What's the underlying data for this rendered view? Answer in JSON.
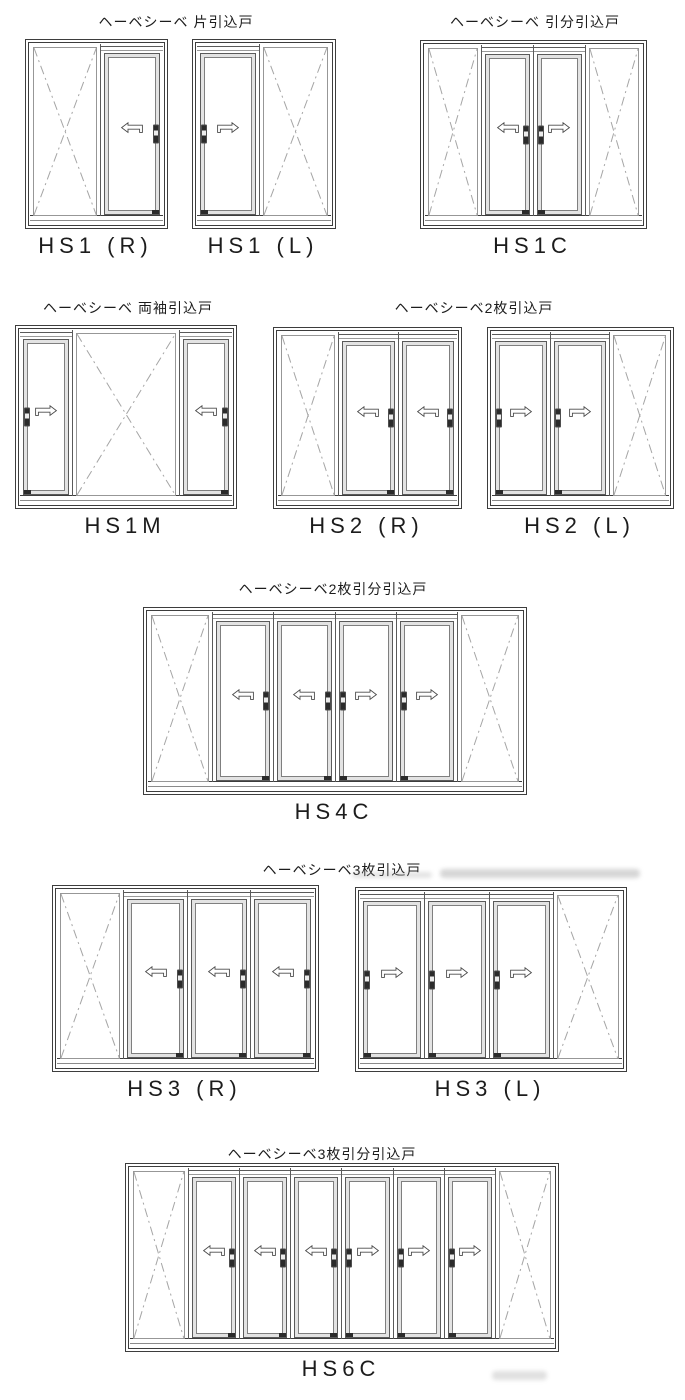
{
  "page": {
    "background": "#ffffff"
  },
  "colors": {
    "frame_line": "#3d3d3d",
    "inner_line": "#5a5a5a",
    "sash_fill": "#e3e3e3",
    "x_line": "#a5a5a5",
    "arrow_line": "#4a4a4a",
    "handle_dark": "#2b2b2b",
    "text": "#1c1c1c"
  },
  "titles": [
    {
      "text": "ヘーベシーベ 片引込戸",
      "cx": 176,
      "y": 12
    },
    {
      "text": "ヘーベシーベ 引分引込戸",
      "cx": 535,
      "y": 12
    },
    {
      "text": "ヘーベシーベ 両袖引込戸",
      "cx": 128,
      "y": 298
    },
    {
      "text": "ヘーベシーベ2枚引込戸",
      "cx": 474,
      "y": 298
    },
    {
      "text": "ヘーベシーベ2枚引分引込戸",
      "cx": 333,
      "y": 579
    },
    {
      "text": "ヘーベシーベ3枚引込戸",
      "cx": 342,
      "y": 860
    },
    {
      "text": "ヘーベシーベ3枚引分引込戸",
      "cx": 322,
      "y": 1144
    }
  ],
  "diagrams": [
    {
      "label": "HS1 (R)",
      "x": 25,
      "y": 39,
      "w": 141,
      "h": 188,
      "panels": [
        {
          "type": "fixed",
          "flex": 1.14
        },
        {
          "type": "door",
          "arrow": "left",
          "handle": "right",
          "flex": 1
        }
      ]
    },
    {
      "label": "HS1 (L)",
      "x": 192,
      "y": 39,
      "w": 142,
      "h": 188,
      "panels": [
        {
          "type": "door",
          "arrow": "right",
          "handle": "left",
          "flex": 1
        },
        {
          "type": "fixed",
          "flex": 1.14
        }
      ]
    },
    {
      "label": "HS1C",
      "x": 420,
      "y": 40,
      "w": 225,
      "h": 187,
      "panels": [
        {
          "type": "fixed",
          "flex": 1.1
        },
        {
          "type": "door",
          "arrow": "left",
          "handle": "right",
          "flex": 1
        },
        {
          "type": "door",
          "arrow": "right",
          "handle": "left",
          "flex": 1
        },
        {
          "type": "fixed",
          "flex": 1.1
        }
      ]
    },
    {
      "label": "HS1M",
      "x": 15,
      "y": 325,
      "w": 220,
      "h": 182,
      "panels": [
        {
          "type": "door",
          "arrow": "right",
          "handle": "left",
          "flex": 1
        },
        {
          "type": "fixed",
          "flex": 2.05
        },
        {
          "type": "door",
          "arrow": "left",
          "handle": "right",
          "flex": 1
        }
      ]
    },
    {
      "label": "HS2 (R)",
      "x": 273,
      "y": 327,
      "w": 187,
      "h": 180,
      "panels": [
        {
          "type": "fixed",
          "flex": 1.03
        },
        {
          "type": "door",
          "arrow": "left",
          "handle": "right",
          "flex": 1
        },
        {
          "type": "door",
          "arrow": "left",
          "handle": "right",
          "flex": 1
        }
      ]
    },
    {
      "label": "HS2 (L)",
      "x": 487,
      "y": 327,
      "w": 185,
      "h": 180,
      "panels": [
        {
          "type": "door",
          "arrow": "right",
          "handle": "left",
          "flex": 1
        },
        {
          "type": "door",
          "arrow": "right",
          "handle": "left",
          "flex": 1
        },
        {
          "type": "fixed",
          "flex": 1.03
        }
      ]
    },
    {
      "label": "HS4C",
      "x": 143,
      "y": 607,
      "w": 382,
      "h": 186,
      "panels": [
        {
          "type": "fixed",
          "flex": 1.06
        },
        {
          "type": "door",
          "arrow": "left",
          "handle": "right",
          "flex": 1
        },
        {
          "type": "door",
          "arrow": "left",
          "handle": "right",
          "flex": 1
        },
        {
          "type": "door",
          "arrow": "right",
          "handle": "left",
          "flex": 1
        },
        {
          "type": "door",
          "arrow": "right",
          "handle": "left",
          "flex": 1
        },
        {
          "type": "fixed",
          "flex": 1.06
        }
      ]
    },
    {
      "label": "HS3 (R)",
      "x": 52,
      "y": 885,
      "w": 265,
      "h": 185,
      "panels": [
        {
          "type": "fixed",
          "flex": 1.06
        },
        {
          "type": "door",
          "arrow": "left",
          "handle": "right",
          "flex": 1
        },
        {
          "type": "door",
          "arrow": "left",
          "handle": "right",
          "flex": 1
        },
        {
          "type": "door",
          "arrow": "left",
          "handle": "right",
          "flex": 1
        }
      ]
    },
    {
      "label": "HS3 (L)",
      "x": 355,
      "y": 887,
      "w": 270,
      "h": 183,
      "panels": [
        {
          "type": "door",
          "arrow": "right",
          "handle": "left",
          "flex": 1
        },
        {
          "type": "door",
          "arrow": "right",
          "handle": "left",
          "flex": 1
        },
        {
          "type": "door",
          "arrow": "right",
          "handle": "left",
          "flex": 1
        },
        {
          "type": "fixed",
          "flex": 1.06
        }
      ]
    },
    {
      "label": "HS6C",
      "x": 125,
      "y": 1163,
      "w": 432,
      "h": 187,
      "panels": [
        {
          "type": "fixed",
          "flex": 1.15
        },
        {
          "type": "door",
          "arrow": "left",
          "handle": "right",
          "flex": 1
        },
        {
          "type": "door",
          "arrow": "left",
          "handle": "right",
          "flex": 1
        },
        {
          "type": "door",
          "arrow": "left",
          "handle": "right",
          "flex": 1
        },
        {
          "type": "door",
          "arrow": "right",
          "handle": "left",
          "flex": 1
        },
        {
          "type": "door",
          "arrow": "right",
          "handle": "left",
          "flex": 1
        },
        {
          "type": "door",
          "arrow": "right",
          "handle": "left",
          "flex": 1
        },
        {
          "type": "fixed",
          "flex": 1.15
        }
      ]
    }
  ],
  "artifacts": [
    {
      "x": 440,
      "y": 869,
      "w": 200,
      "h": 9,
      "opacity": 0.4
    },
    {
      "x": 352,
      "y": 872,
      "w": 80,
      "h": 6,
      "opacity": 0.28
    },
    {
      "x": 492,
      "y": 1371,
      "w": 55,
      "h": 9,
      "opacity": 0.3
    }
  ]
}
